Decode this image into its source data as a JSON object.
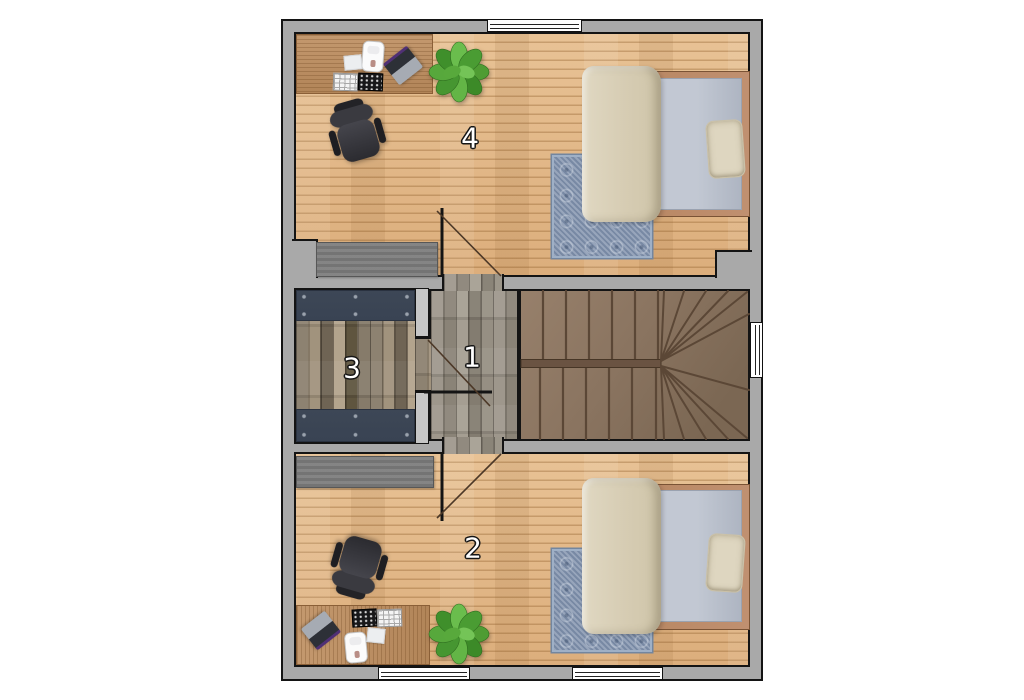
{
  "rooms": {
    "hallway": {
      "label": "1"
    },
    "bedroom_bottom": {
      "label": "2"
    },
    "storage": {
      "label": "3"
    },
    "bedroom_top": {
      "label": "4"
    }
  },
  "colors": {
    "wall": "#a9a9a9",
    "outline": "#141414",
    "oak": "#e3ba8b",
    "hall_wood": "#958e83",
    "rustic_wood": "#867b6a",
    "panel": "#3d4756",
    "stairs_wood": "#8d7560",
    "rug": "#8191ab",
    "blanket": "#d6ccb3",
    "sheet": "#c2c8d3",
    "bed_frame": "#b5835d",
    "pillow": "#ded6c0",
    "desk_wood": "#bd8d5e",
    "dresser": "#7d7d7d",
    "chair": "#313136",
    "plant": "#4f9c33"
  }
}
